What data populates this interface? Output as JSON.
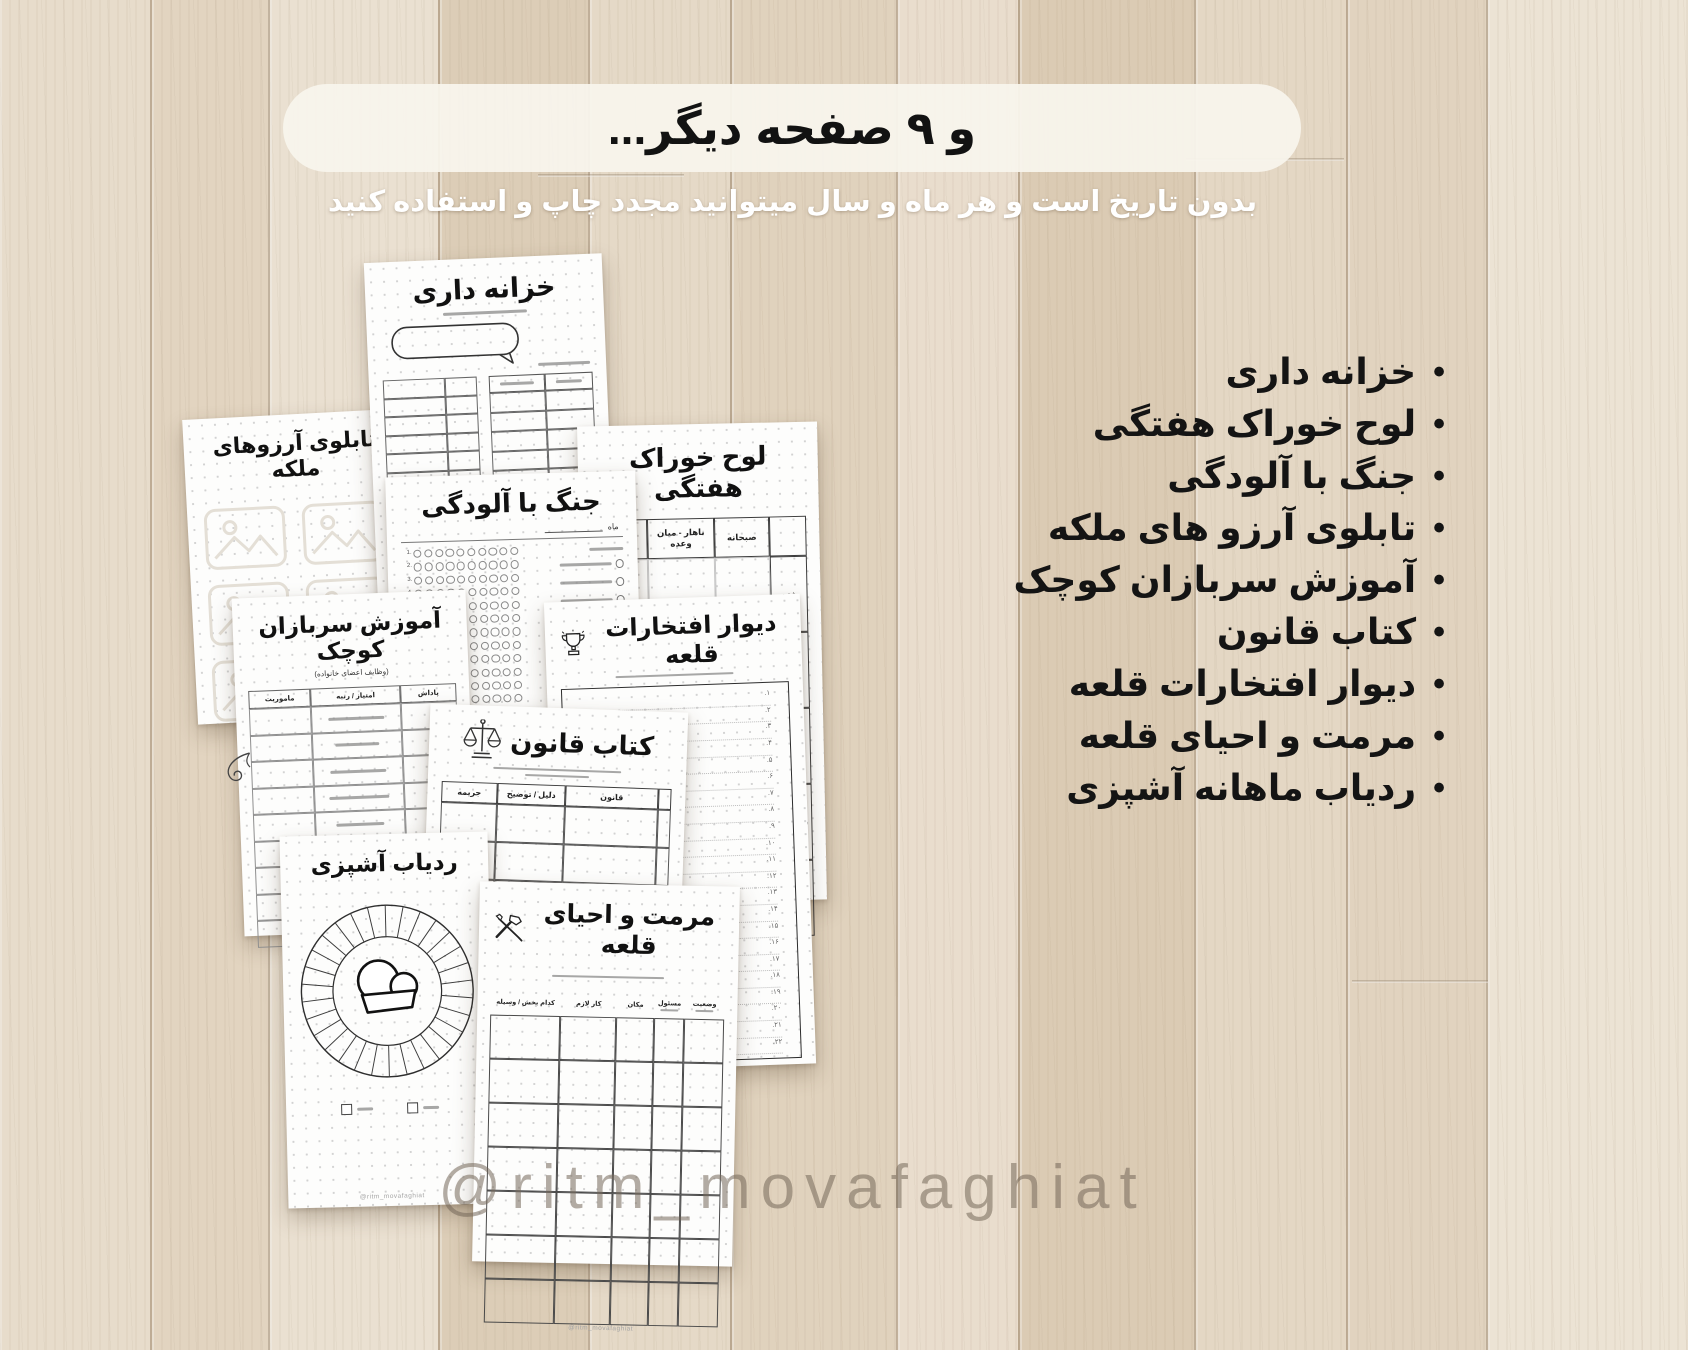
{
  "banner": {
    "title": "و ۹ صفحه دیگر..."
  },
  "subtitle": "بدون تاریخ است و هر ماه و سال میتوانید مجدد چاپ و استفاده کنید",
  "features": [
    "خزانه داری",
    "لوح خوراک هفتگی",
    "جنگ با آلودگی",
    "تابلوی آرزو های ملکه",
    "آموزش سربازان کوچک",
    "کتاب قانون",
    "دیوار افتخارات قلعه",
    "مرمت و احیای قلعه",
    "ردیاب ماهانه آشپزی"
  ],
  "watermark": "@ritm_movafaghiat",
  "pages": {
    "treasury": {
      "title": "خزانه داری"
    },
    "wishboard": {
      "title": "تابلوی آرزوهای ملکه"
    },
    "pollution": {
      "title": "جنگ با آلودگی",
      "month_label": "ماه"
    },
    "weekly_food": {
      "title": "لوح خوراک هفتگی",
      "columns": [
        "صبحانه",
        "ناهار - میان وعده",
        "شام"
      ],
      "days": [
        "شنبه",
        "یکشنبه",
        "دوشنبه",
        "سه شنبه",
        "چهارشنبه"
      ]
    },
    "training": {
      "title": "آموزش سربازان کوچک",
      "subtitle": "(وظایف اعضای خانواده)",
      "columns": [
        "پاداش",
        "امتیاز / رتبه",
        "ماموریت"
      ]
    },
    "honors": {
      "title": "دیوار افتخارات قلعه"
    },
    "law": {
      "title": "کتاب قانون",
      "columns": [
        "قانون",
        "دلیل / توضیح",
        "جریمه"
      ]
    },
    "cooking": {
      "title": "ردیاب آشپزی",
      "footer": "@ritm_movafaghiat"
    },
    "restoration": {
      "title": "مرمت و احیای قلعه",
      "columns": [
        "وضعیت",
        "مسئول",
        "مکان",
        "کار لازم",
        "کدام بخش / وسیله"
      ],
      "footer": "@ritm_movafaghiat"
    }
  },
  "colors": {
    "banner_bg": "#f8f4ec",
    "text_dark": "#141414",
    "subtitle_white": "#ffffff",
    "watermark_gray": "#74675a",
    "wood_light": "#eae0d1",
    "wood_dark": "#dbcbb4"
  }
}
